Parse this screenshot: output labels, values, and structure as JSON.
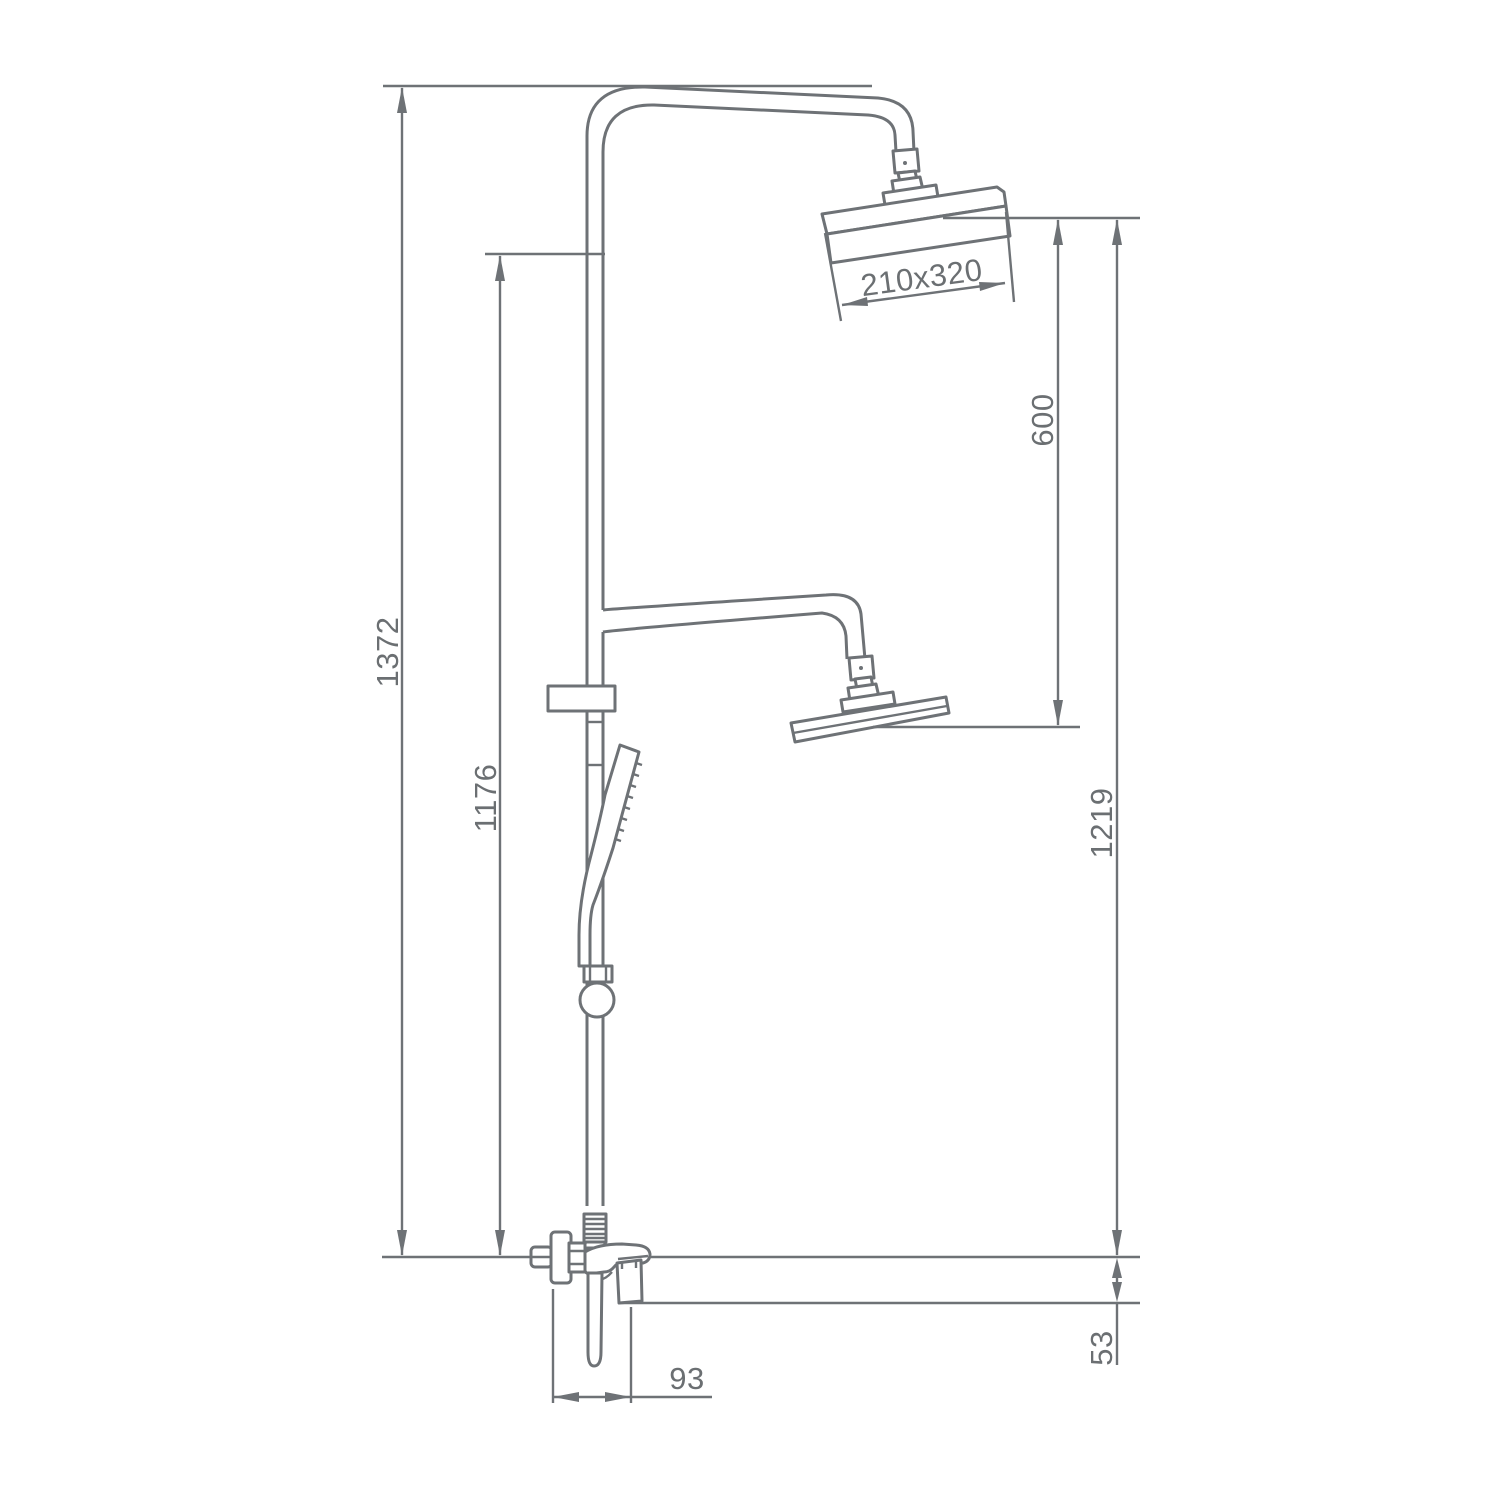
{
  "drawing": {
    "background_color": "#ffffff",
    "line_color": "#6e7276",
    "text_color": "#6b6f72",
    "dimensions": {
      "total_height": "1372",
      "column_height": "1176",
      "head_gap": "600",
      "overhead_height": "1219",
      "mixer_drop": "53",
      "spout_reach": "93",
      "head_size": "210x320"
    }
  }
}
